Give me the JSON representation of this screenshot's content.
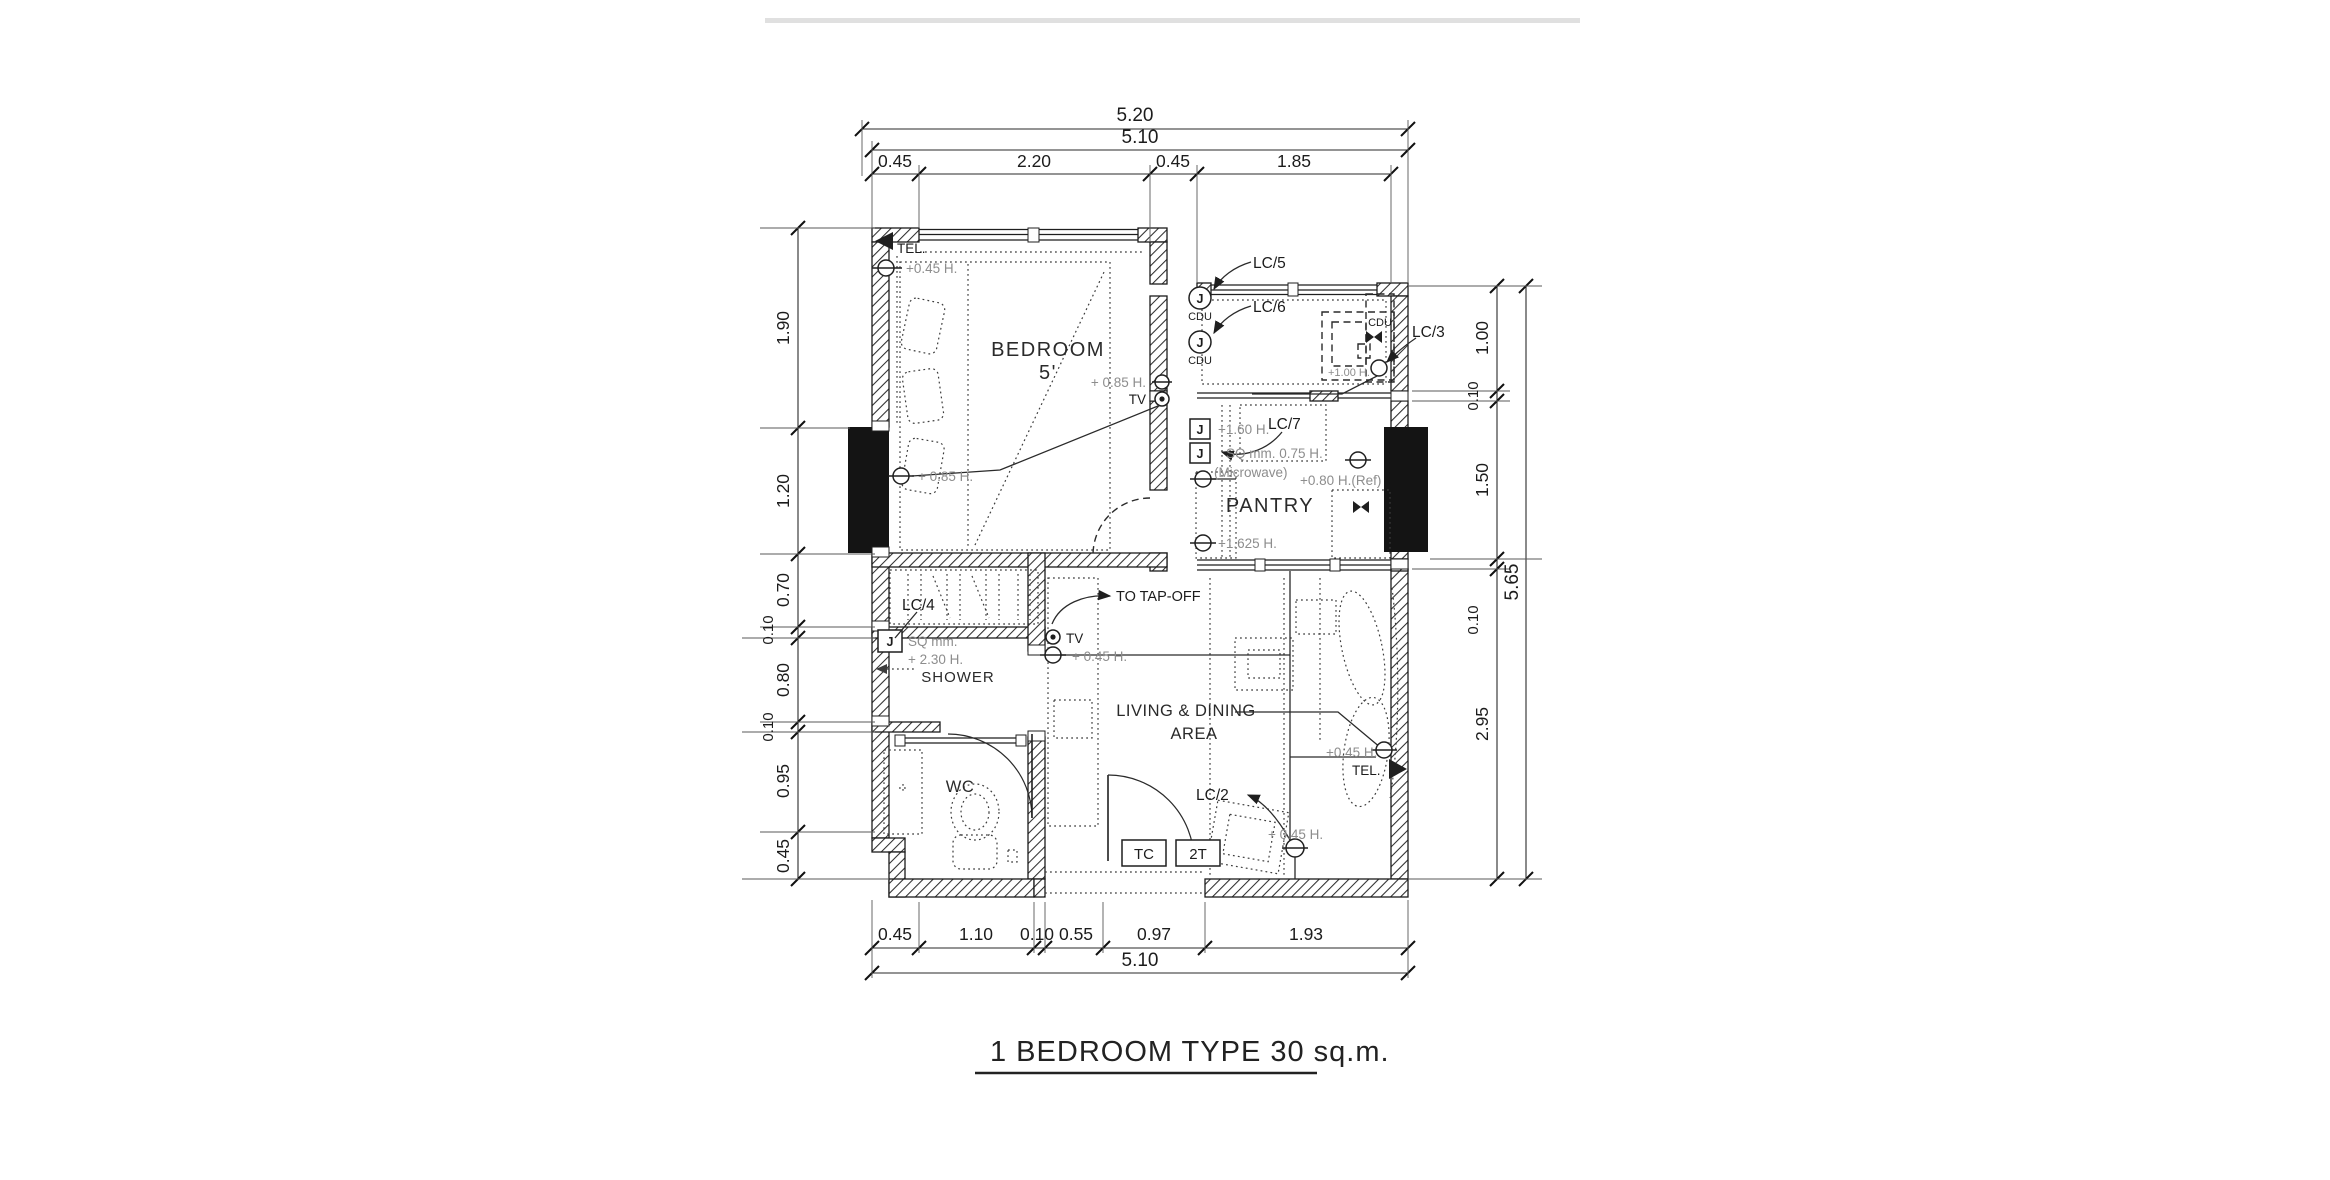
{
  "page": {
    "title_label": "1 BEDROOM TYPE  30 sq.m."
  },
  "rooms": {
    "bedroom_line1": "BEDROOM",
    "bedroom_line2": "5'",
    "pantry": "PANTRY",
    "shower": "SHOWER",
    "wc": "WC",
    "living_line1": "LIVING & DINING",
    "living_line2": "AREA"
  },
  "annotations": {
    "tel_left": "TEL.",
    "tel_left_height": "+0.45 H.",
    "bed_outlet_height": "+ 0.85 H.",
    "bed_tv_height": "+ 0.85 H.",
    "bed_tv": "TV",
    "lc2": "LC/2",
    "lc3": "LC/3",
    "lc4": "LC/4",
    "lc5": "LC/5",
    "lc6": "LC/6",
    "lc7": "LC/7",
    "cdu_top": "CDU",
    "cdu_bottom": "CDU",
    "cdu_washer": "CDU",
    "washer_height": "+1.00 H.",
    "j_label": "J",
    "pantry_j1_height": "+1.60 H.",
    "pantry_j2_spec": "SQ  mm.  0.75 H.",
    "microwave": "(Microwave)",
    "pantry_outlet_height": "+1.625 H.",
    "fridge_outlet_height": "+0.80 H.(Ref)",
    "tap_off": "TO TAP-OFF",
    "hall_tv": "TV",
    "hall_tv_height": "+ 0.45 H.",
    "shower_spec1": "SQ mm.",
    "shower_spec2": "+ 2.30 H.",
    "tc": "TC",
    "t2": "2T",
    "lc2_height": "+ 0.45 H.",
    "tel_right": "TEL.",
    "tel_right_height": "+0.45 H."
  },
  "dimensions": {
    "top_overall": "5.20",
    "top_inner": "5.10",
    "top_segments": [
      "0.45",
      "2.20",
      "0.45",
      "1.85"
    ],
    "bottom_segments": [
      "0.45",
      "1.10",
      "0.10",
      "0.55",
      "0.97",
      "1.93"
    ],
    "bottom_overall": "5.10",
    "left_segments": [
      "1.90",
      "1.20",
      "0.70",
      "0.10",
      "0.80",
      "0.10",
      "0.95",
      "0.45"
    ],
    "right_segments": [
      "1.00",
      "0.10",
      "1.50",
      "0.10",
      "2.95"
    ],
    "right_overall": "5.65"
  }
}
